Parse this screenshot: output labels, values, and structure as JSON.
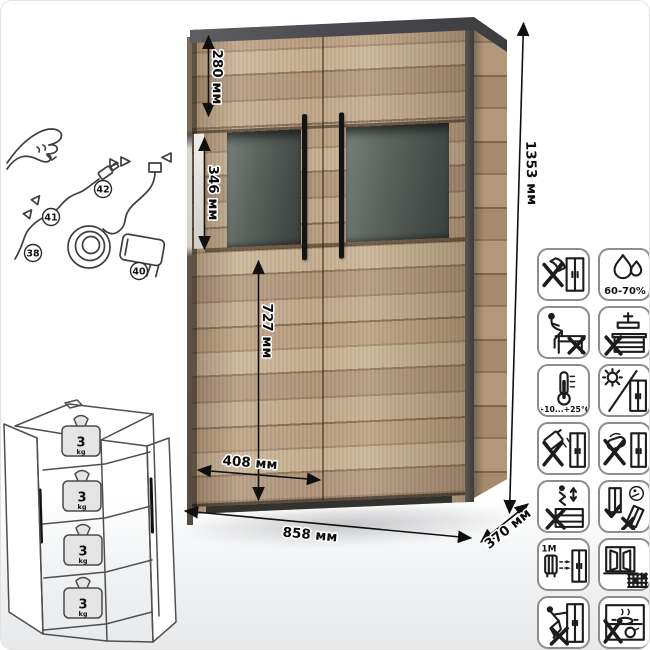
{
  "product": {
    "type": "display cabinet with LED lighting",
    "dimensions": {
      "upper_door_height": "280 мм",
      "glass_section_height": "346 мм",
      "lower_door_height": "727 мм",
      "door_width": "408 мм",
      "overall_width": "858 мм",
      "depth": "370 мм",
      "overall_height": "1353 мм"
    }
  },
  "wiring_diagram": {
    "part_labels": [
      "38",
      "41",
      "42",
      "40"
    ]
  },
  "shelf_load": {
    "value": "3",
    "unit": "kg"
  },
  "care_icons": [
    {
      "name": "no-sharp-tools"
    },
    {
      "name": "humidity-range",
      "label": "60-70%"
    },
    {
      "name": "no-sitting"
    },
    {
      "name": "no-press-load"
    },
    {
      "name": "temperature-range",
      "label": "+10...+25°C"
    },
    {
      "name": "no-direct-sunlight"
    },
    {
      "name": "no-aggressive-liquids"
    },
    {
      "name": "no-abrasive-cleaners"
    },
    {
      "name": "no-climbing"
    },
    {
      "name": "transport-upright"
    },
    {
      "name": "keep-1m-from-heaters",
      "label": "≥1М"
    },
    {
      "name": "ventilate-room"
    },
    {
      "name": "no-dragging"
    },
    {
      "name": "no-hot-objects"
    }
  ]
}
